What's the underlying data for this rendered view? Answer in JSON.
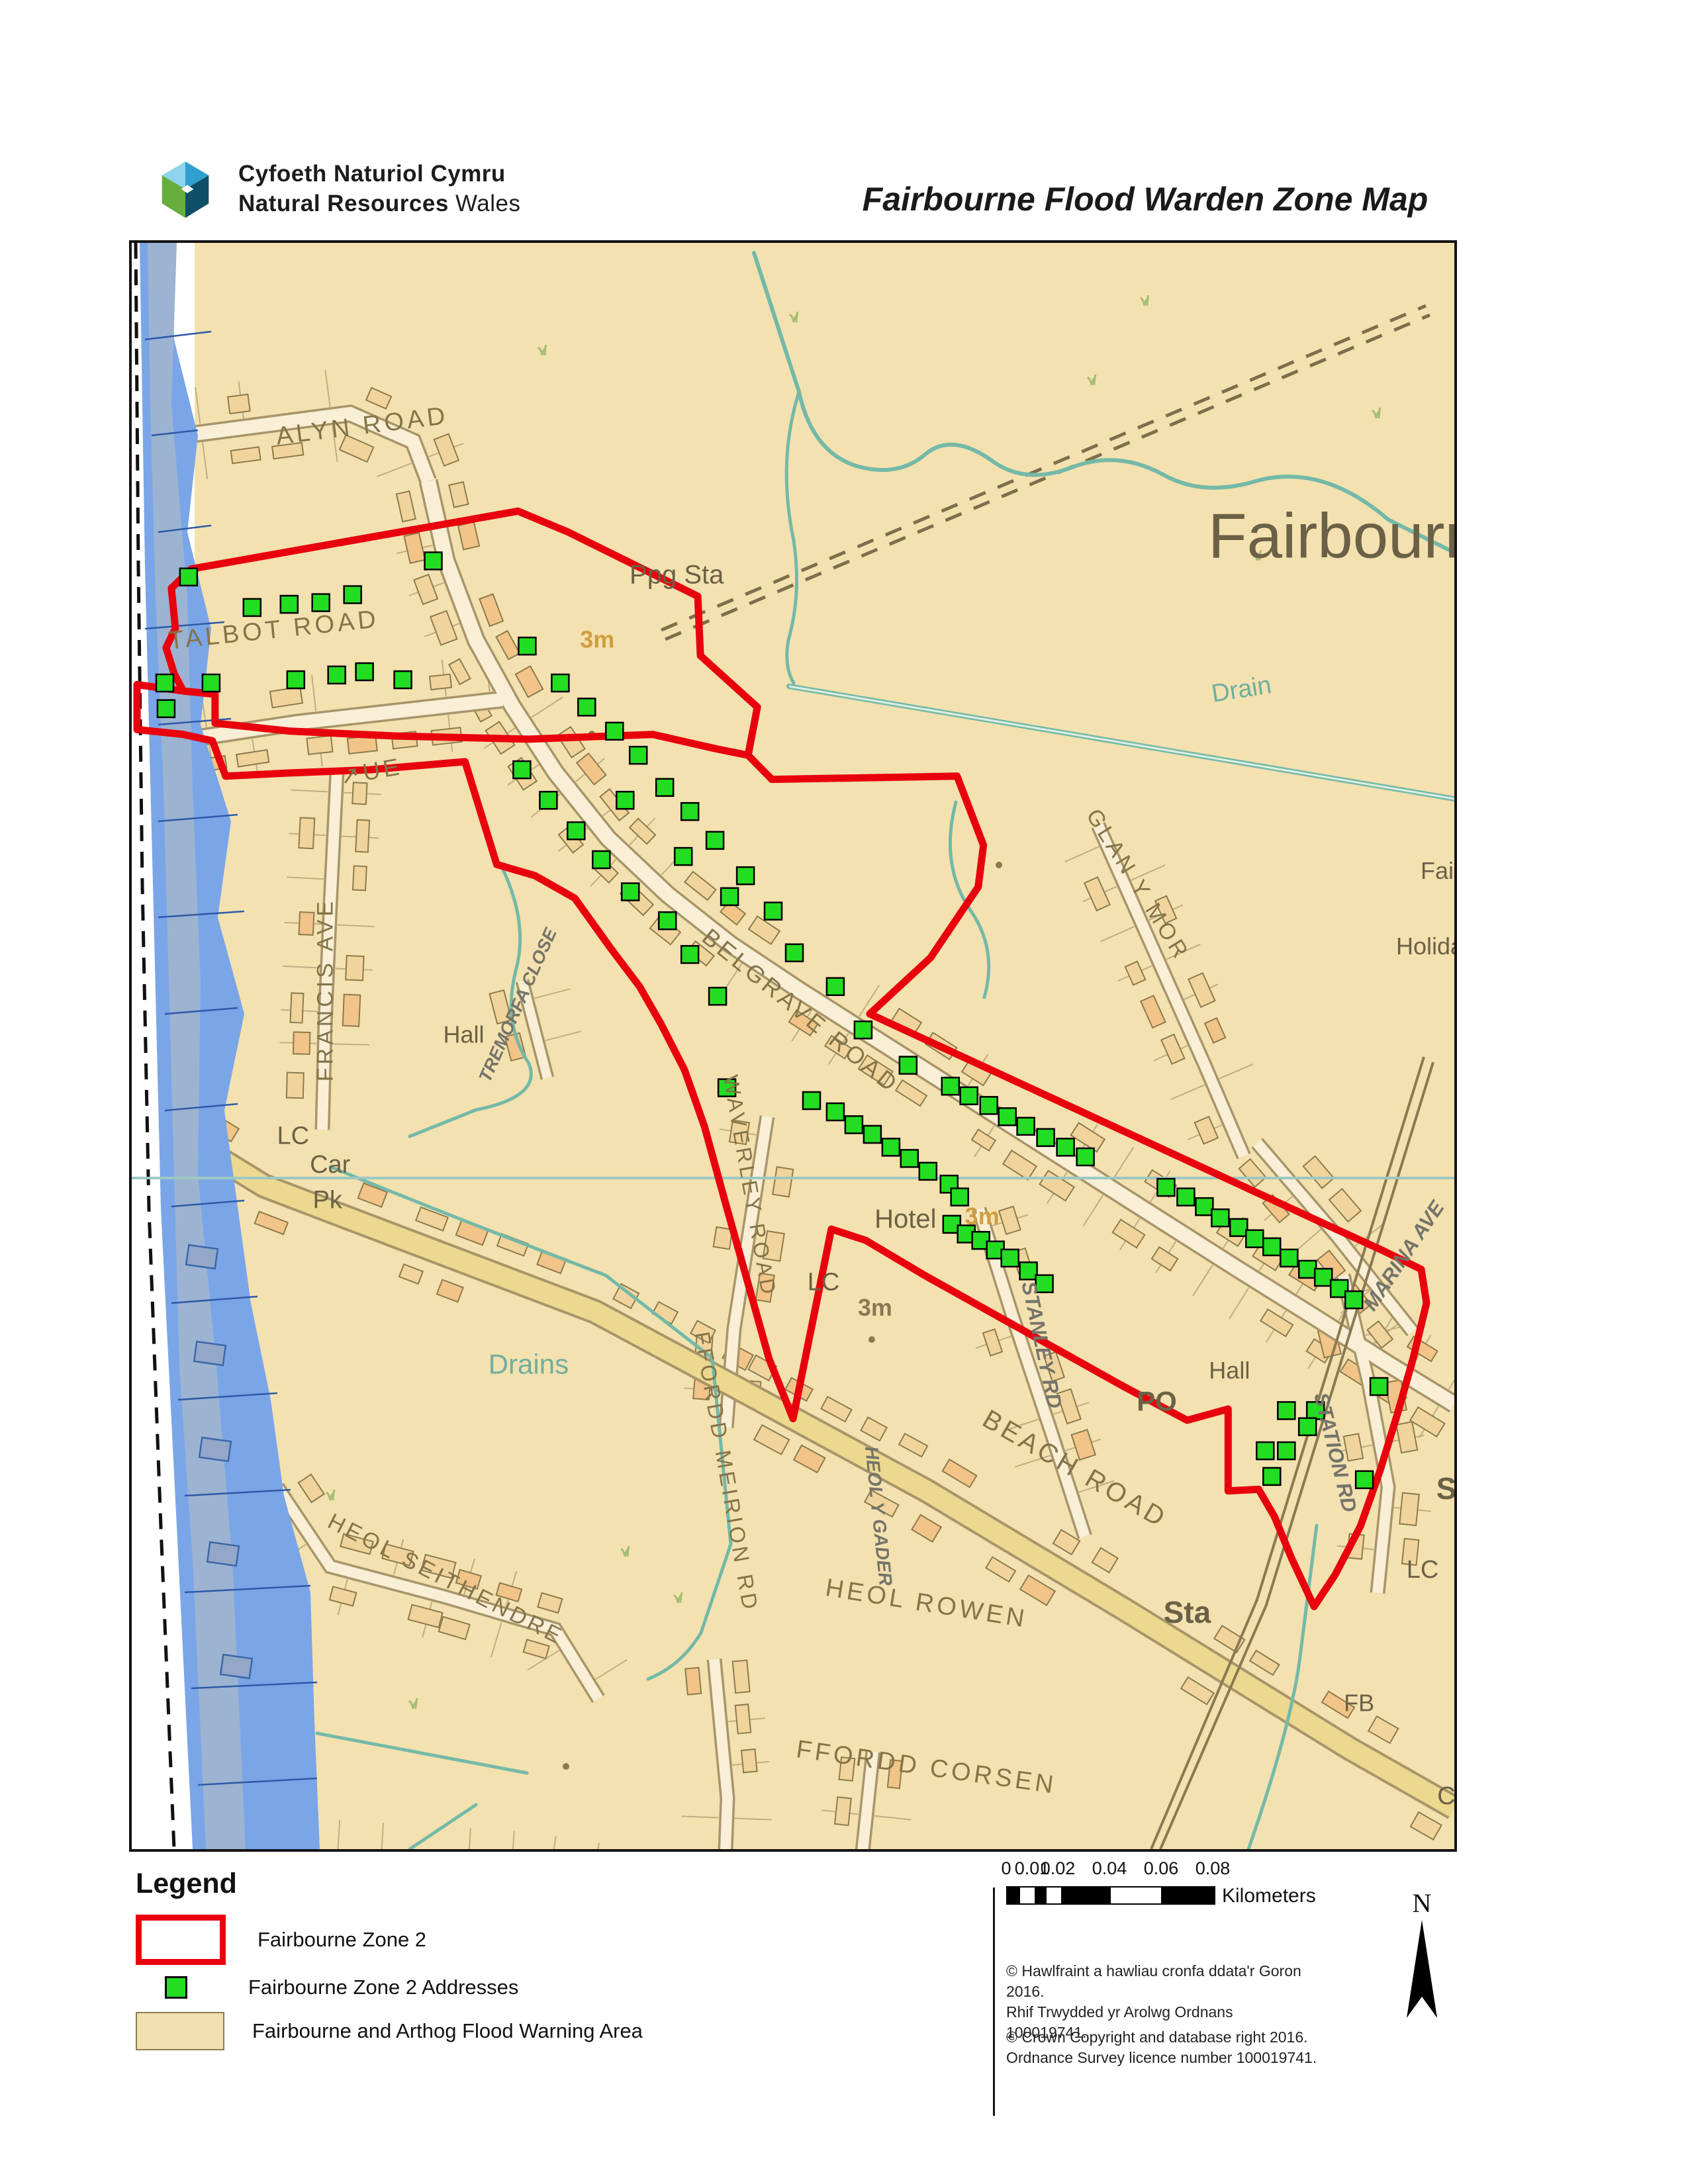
{
  "header": {
    "org_line1": "Cyfoeth Naturiol Cymru",
    "org_line2_bold": "Natural Resources",
    "org_line2_rest": " Wales",
    "title": "Fairbourne Flood Warden Zone Map"
  },
  "map": {
    "labels": [
      {
        "t": "ALYN ROAD",
        "x": 17.5,
        "y": 11.9,
        "r": -7,
        "c": "road",
        "s": 38
      },
      {
        "t": "TALBOT ROAD",
        "x": 10.8,
        "y": 24.6,
        "r": -6,
        "c": "road",
        "s": 38
      },
      {
        "t": "Ppg Sta",
        "x": 41.2,
        "y": 21.2,
        "r": 0,
        "c": "place",
        "s": 40
      },
      {
        "t": "Fairbourne",
        "x": 93.0,
        "y": 19.6,
        "r": 0,
        "c": "big",
        "s": 96
      },
      {
        "t": "Drain",
        "x": 84.0,
        "y": 28.3,
        "r": -9,
        "c": "teal",
        "s": 38
      },
      {
        "t": "GLAN Y MOR",
        "x": 75.6,
        "y": 40.2,
        "r": 58,
        "c": "road",
        "s": 34
      },
      {
        "t": "Fair",
        "x": 99.0,
        "y": 39.6,
        "r": 0,
        "c": "place",
        "s": 36
      },
      {
        "t": "Holiday",
        "x": 98.6,
        "y": 44.3,
        "r": 0,
        "c": "place",
        "s": 36
      },
      {
        "t": "FRANCIS AVE",
        "x": 15.2,
        "y": 46.5,
        "r": -90,
        "c": "road",
        "s": 34
      },
      {
        "t": "↗UE",
        "x": 18.2,
        "y": 33.4,
        "r": -10,
        "c": "road",
        "s": 36
      },
      {
        "t": "Hall",
        "x": 25.1,
        "y": 49.8,
        "r": 0,
        "c": "place",
        "s": 36
      },
      {
        "t": "TREMORFA CLOSE",
        "x": 29.6,
        "y": 47.6,
        "r": -66,
        "c": "grey",
        "s": 27
      },
      {
        "t": "BELGRAVE ROAD",
        "x": 50.2,
        "y": 48.2,
        "r": 39,
        "c": "road",
        "s": 36
      },
      {
        "t": "WAVERLEY ROAD",
        "x": 46.2,
        "y": 58.8,
        "r": 80,
        "c": "road",
        "s": 32
      },
      {
        "t": "LC",
        "x": 12.2,
        "y": 56.1,
        "r": 0,
        "c": "place",
        "s": 38
      },
      {
        "t": "Car",
        "x": 15.0,
        "y": 57.9,
        "r": 0,
        "c": "place",
        "s": 38
      },
      {
        "t": "Pk",
        "x": 14.8,
        "y": 60.1,
        "r": 0,
        "c": "place",
        "s": 38
      },
      {
        "t": "Hotel",
        "x": 58.5,
        "y": 61.3,
        "r": 0,
        "c": "place",
        "s": 40
      },
      {
        "t": "LC",
        "x": 52.3,
        "y": 65.2,
        "r": 0,
        "c": "place",
        "s": 38
      },
      {
        "t": "3m",
        "x": 35.2,
        "y": 25.2,
        "r": 0,
        "c": "orange",
        "s": 36
      },
      {
        "t": "3m",
        "x": 64.3,
        "y": 61.1,
        "r": 0,
        "c": "orange",
        "s": 36
      },
      {
        "t": "3m",
        "x": 56.2,
        "y": 66.8,
        "r": 0,
        "c": "dark3m",
        "s": 36
      },
      {
        "t": "Drains",
        "x": 30.0,
        "y": 70.4,
        "r": 0,
        "c": "teal",
        "s": 42
      },
      {
        "t": "HEOL SEITHENDRE",
        "x": 23.5,
        "y": 83.6,
        "r": 27,
        "c": "road",
        "s": 34
      },
      {
        "t": "FFORDD MEIRION RD",
        "x": 44.4,
        "y": 76.6,
        "r": 80,
        "c": "road",
        "s": 33
      },
      {
        "t": "HEOL Y GADER",
        "x": 56.0,
        "y": 79.3,
        "r": 84,
        "c": "grey",
        "s": 28
      },
      {
        "t": "STANLEY RD",
        "x": 68.3,
        "y": 68.7,
        "r": 78,
        "c": "grey",
        "s": 31
      },
      {
        "t": "BEACH ROAD",
        "x": 71.0,
        "y": 76.8,
        "r": 30,
        "c": "road",
        "s": 40
      },
      {
        "t": "PO",
        "x": 77.5,
        "y": 72.7,
        "r": 0,
        "c": "placebold",
        "s": 42
      },
      {
        "t": "Hall",
        "x": 83.0,
        "y": 70.7,
        "r": 0,
        "c": "place",
        "s": 36
      },
      {
        "t": "STATION RD",
        "x": 90.5,
        "y": 75.4,
        "r": 76,
        "c": "grey",
        "s": 31
      },
      {
        "t": "MARINA AVE",
        "x": 96.6,
        "y": 63.3,
        "r": -56,
        "c": "grey",
        "s": 31
      },
      {
        "t": "HEOL ROWEN",
        "x": 60.0,
        "y": 85.2,
        "r": 9,
        "c": "road",
        "s": 38
      },
      {
        "t": "Sta",
        "x": 79.8,
        "y": 85.9,
        "r": 0,
        "c": "placebold",
        "s": 46
      },
      {
        "t": "FFORDD CORSEN",
        "x": 60.0,
        "y": 95.4,
        "r": 8,
        "c": "road",
        "s": 38
      },
      {
        "t": "FB",
        "x": 92.8,
        "y": 91.4,
        "r": 0,
        "c": "place",
        "s": 36
      },
      {
        "t": "LC",
        "x": 97.6,
        "y": 83.1,
        "r": 0,
        "c": "place",
        "s": 38
      },
      {
        "t": "S",
        "x": 99.4,
        "y": 78.2,
        "r": 0,
        "c": "placebold",
        "s": 46
      },
      {
        "t": "C",
        "x": 99.4,
        "y": 97.2,
        "r": 0,
        "c": "place",
        "s": 38
      }
    ],
    "addresses": [
      [
        4.3,
        20.8
      ],
      [
        9.1,
        22.7
      ],
      [
        11.9,
        22.5
      ],
      [
        14.3,
        22.4
      ],
      [
        16.7,
        21.9
      ],
      [
        22.8,
        19.8
      ],
      [
        2.5,
        27.4
      ],
      [
        6,
        27.4
      ],
      [
        12.4,
        27.2
      ],
      [
        15.5,
        26.9
      ],
      [
        17.6,
        26.7
      ],
      [
        20.5,
        27.2
      ],
      [
        2.6,
        29
      ],
      [
        29.9,
        25.1
      ],
      [
        32.4,
        27.4
      ],
      [
        34.4,
        28.9
      ],
      [
        36.5,
        30.4
      ],
      [
        38.3,
        31.9
      ],
      [
        40.3,
        33.9
      ],
      [
        42.2,
        35.4
      ],
      [
        44.1,
        37.2
      ],
      [
        46.4,
        39.4
      ],
      [
        48.5,
        41.6
      ],
      [
        50.1,
        44.2
      ],
      [
        29.5,
        32.8
      ],
      [
        31.5,
        34.7
      ],
      [
        33.6,
        36.6
      ],
      [
        35.5,
        38.4
      ],
      [
        37.7,
        40.4
      ],
      [
        40.5,
        42.2
      ],
      [
        42.2,
        44.3
      ],
      [
        44.3,
        46.9
      ],
      [
        37.3,
        34.7
      ],
      [
        41.7,
        38.2
      ],
      [
        45.2,
        40.7
      ],
      [
        45,
        52.6
      ],
      [
        53.2,
        46.3
      ],
      [
        55.3,
        49
      ],
      [
        58.7,
        51.2
      ],
      [
        61.9,
        52.5
      ],
      [
        63.3,
        53.1
      ],
      [
        64.8,
        53.7
      ],
      [
        66.2,
        54.4
      ],
      [
        67.6,
        55
      ],
      [
        69.1,
        55.7
      ],
      [
        70.6,
        56.3
      ],
      [
        72.1,
        56.9
      ],
      [
        51.4,
        53.4
      ],
      [
        53.2,
        54.1
      ],
      [
        54.6,
        54.9
      ],
      [
        56,
        55.5
      ],
      [
        57.4,
        56.3
      ],
      [
        58.8,
        57
      ],
      [
        60.2,
        57.8
      ],
      [
        61.8,
        58.6
      ],
      [
        62.6,
        59.4
      ],
      [
        78.2,
        58.8
      ],
      [
        79.7,
        59.4
      ],
      [
        81.1,
        60
      ],
      [
        82.3,
        60.7
      ],
      [
        83.7,
        61.3
      ],
      [
        84.9,
        62
      ],
      [
        86.2,
        62.5
      ],
      [
        87.5,
        63.2
      ],
      [
        88.9,
        63.9
      ],
      [
        90.1,
        64.4
      ],
      [
        91.3,
        65.1
      ],
      [
        92.4,
        65.8
      ],
      [
        62,
        61.1
      ],
      [
        63.1,
        61.7
      ],
      [
        64.2,
        62.1
      ],
      [
        65.3,
        62.7
      ],
      [
        66.4,
        63.2
      ],
      [
        67.8,
        64
      ],
      [
        69,
        64.8
      ],
      [
        87.3,
        72.7
      ],
      [
        89.5,
        72.7
      ],
      [
        88.9,
        73.7
      ],
      [
        85.7,
        75.2
      ],
      [
        87.3,
        75.2
      ],
      [
        86.2,
        76.8
      ],
      [
        93.2,
        77
      ],
      [
        94.3,
        71.2
      ]
    ],
    "zone2_outline": [
      [
        4.5,
        20.3
      ],
      [
        29.2,
        16.7
      ],
      [
        33,
        18
      ],
      [
        42.8,
        22
      ],
      [
        43,
        25.7
      ],
      [
        47.3,
        28.9
      ],
      [
        46.6,
        31.9
      ],
      [
        48.4,
        33.4
      ],
      [
        62.4,
        33.2
      ],
      [
        64.4,
        37.5
      ],
      [
        64,
        40.1
      ],
      [
        60.4,
        44.5
      ],
      [
        55.8,
        48
      ],
      [
        60,
        49.6
      ],
      [
        65,
        51.5
      ],
      [
        70,
        53.4
      ],
      [
        75,
        55.3
      ],
      [
        80,
        57.2
      ],
      [
        85,
        59.1
      ],
      [
        90,
        61
      ],
      [
        94.5,
        62.7
      ],
      [
        97.5,
        63.9
      ],
      [
        97.9,
        66
      ],
      [
        96.9,
        69.4
      ],
      [
        95.7,
        72.9
      ],
      [
        94.4,
        76.4
      ],
      [
        92.9,
        79.9
      ],
      [
        91,
        82.9
      ],
      [
        89.4,
        84.9
      ],
      [
        87.7,
        81.9
      ],
      [
        86.4,
        79.3
      ],
      [
        85.2,
        77.6
      ],
      [
        82.9,
        77.7
      ],
      [
        82.9,
        72.6
      ],
      [
        79.8,
        73.3
      ],
      [
        75,
        71.2
      ],
      [
        70,
        68.9
      ],
      [
        65,
        66.6
      ],
      [
        60,
        64.3
      ],
      [
        55.5,
        62.1
      ],
      [
        52.9,
        61.4
      ],
      [
        50,
        73.2
      ],
      [
        48.2,
        69.5
      ],
      [
        46.5,
        64.5
      ],
      [
        44.8,
        59.5
      ],
      [
        43.3,
        55
      ],
      [
        41.8,
        51.5
      ],
      [
        40,
        48.6
      ],
      [
        38.4,
        46.3
      ],
      [
        36.2,
        43.9
      ],
      [
        33.5,
        40.8
      ],
      [
        30.5,
        39.4
      ],
      [
        27.6,
        38.7
      ],
      [
        25.2,
        32.3
      ],
      [
        18,
        32.8
      ],
      [
        12,
        33
      ],
      [
        7.1,
        33.2
      ],
      [
        6.1,
        31
      ],
      [
        3.9,
        30.6
      ],
      [
        0.4,
        30.3
      ],
      [
        0.4,
        27.5
      ],
      [
        3.9,
        27.9
      ],
      [
        6.3,
        28.1
      ],
      [
        6.3,
        29.9
      ],
      [
        12,
        30.4
      ],
      [
        20,
        30.7
      ],
      [
        30,
        30.9
      ],
      [
        39.4,
        30.6
      ],
      [
        44.2,
        31.5
      ],
      [
        46.6,
        31.9
      ]
    ],
    "zone2_outline_west": [
      [
        3.9,
        27.9
      ],
      [
        3.2,
        26.8
      ],
      [
        2.6,
        25.2
      ],
      [
        3.3,
        24
      ],
      [
        3,
        21.5
      ],
      [
        4.5,
        20.3
      ]
    ],
    "colors": {
      "zone": "#e8000d",
      "address_fill": "#22dd22",
      "warning_area": "#f4e1b0",
      "water": "#7aa6e8"
    }
  },
  "legend": {
    "heading": "Legend",
    "items": [
      {
        "label": "Fairbourne Zone 2",
        "swatch": "zone-outline"
      },
      {
        "label": "Fairbourne Zone 2 Addresses",
        "swatch": "address"
      },
      {
        "label": "Fairbourne and Arthog Flood Warning Area",
        "swatch": "warning-area"
      }
    ]
  },
  "scalebar": {
    "ticks": [
      "0",
      "0.01",
      "0.02",
      "0.04",
      "0.06",
      "0.08"
    ],
    "unit": "Kilometers"
  },
  "north": {
    "label": "N"
  },
  "copyright": {
    "welsh_1": "© Hawlfraint a hawliau cronfa ddata'r Goron 2016.",
    "welsh_2": "Rhif Trwydded yr Arolwg Ordnans 100019741.",
    "english_1": "© Crown Copyright and database right 2016.",
    "english_2": "Ordnance Survey licence number 100019741."
  }
}
